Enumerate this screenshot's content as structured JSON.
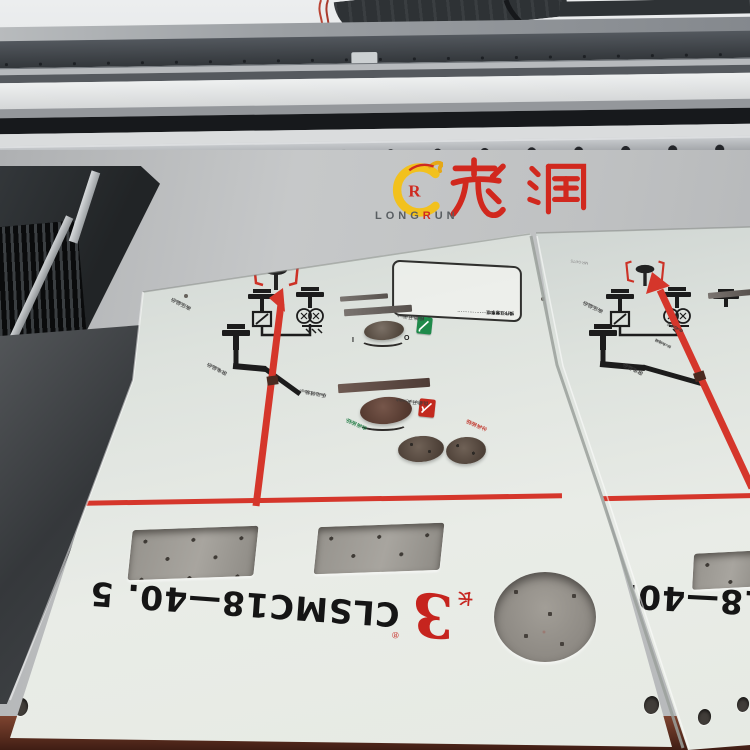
{
  "watermark": {
    "zh": "龙润",
    "latin_prefix": "LONG",
    "latin_accent": "R",
    "latin_suffix": "UN",
    "yellow": "#f2c11d",
    "red": "#d1281e"
  },
  "panel": {
    "model": "CLSMC18—40. 5",
    "brand_mark": "3",
    "brand_char": "长",
    "brand_reg": "®",
    "fuse_code": "MR-04/T5",
    "knob_on": "I",
    "knob_off": "O",
    "labels": {
      "hv": {
        "zh": "高压显示",
        "en": "HV indicator"
      },
      "dc": {
        "zh": "带电显示",
        "en": "DC indicator"
      },
      "earthing": {
        "zh": "接地开关",
        "en": "Earthing switch"
      },
      "manual": {
        "zh": "手动储能",
        "en": "Manual Charge"
      },
      "load": {
        "zh": "负荷开关",
        "en": "Load-break switch"
      },
      "close": {
        "zh": "合闸按钮",
        "en": "Close button"
      },
      "open": {
        "zh": "分闸按钮",
        "en": "Open button"
      },
      "charged": {
        "zh": "合:已储能",
        "en": "Charged"
      },
      "discharged": {
        "zh": "分:未储能",
        "en": "Discharged"
      }
    },
    "instructions": {
      "title": "操作注意事项",
      "lines": [
        "·································",
        "·································",
        "·································",
        "····················"
      ]
    }
  },
  "colors": {
    "print_red": "#d5362b",
    "print_black": "#1c1c1c",
    "panel_white": "#e6eae3",
    "bed_gray": "#c2c4c5",
    "table_maroon": "#5a2c1e"
  }
}
